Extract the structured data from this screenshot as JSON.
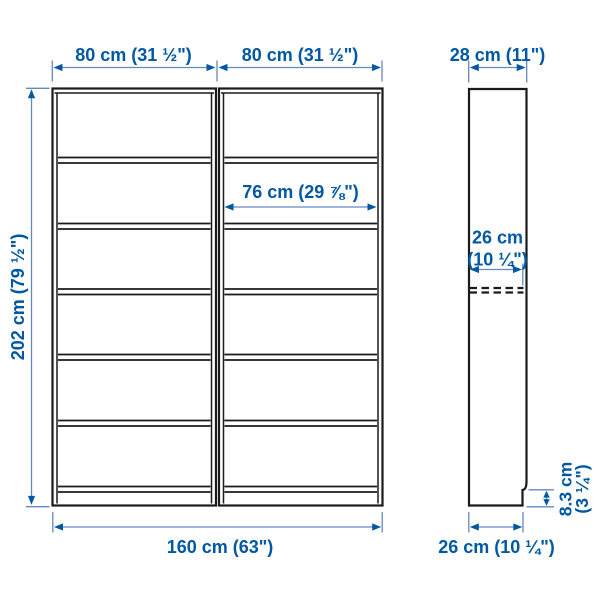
{
  "colors": {
    "accent": "#0058a3",
    "dim_line": "#6488c4",
    "outline": "#1a1a1a",
    "background": "#ffffff"
  },
  "dims": {
    "unit_width_left": "80 cm (31 ½\")",
    "unit_width_right": "80 cm (31 ½\")",
    "top_depth": "28 cm (11\")",
    "inner_width": "76 cm (29 ⅞\")",
    "total_height": "202 cm (79 ½\")",
    "shelf_depth_line1": "26 cm",
    "shelf_depth_line2": "(10 ¼\")",
    "total_width": "160 cm (63\")",
    "bottom_depth": "26 cm (10 ¼\")",
    "plinth_height_line1": "8.3 cm",
    "plinth_height_line2": "(3 ¼\")"
  }
}
